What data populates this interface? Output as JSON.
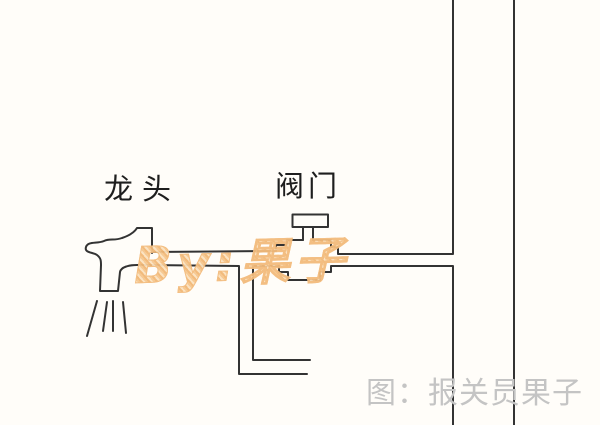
{
  "labels": {
    "faucet": "龙头",
    "valve": "阀门"
  },
  "watermark": {
    "text": "By:果子",
    "color": "#f5c48b"
  },
  "caption": {
    "text": "图：报关员果子",
    "color": "#c4c4c4"
  },
  "diagram": {
    "line_color": "#333333",
    "background_color": "#fffdf9",
    "elements": [
      "faucet",
      "water-spray",
      "horizontal-pipe",
      "down-branch-pipe",
      "valve",
      "vertical-riser-lines"
    ]
  }
}
